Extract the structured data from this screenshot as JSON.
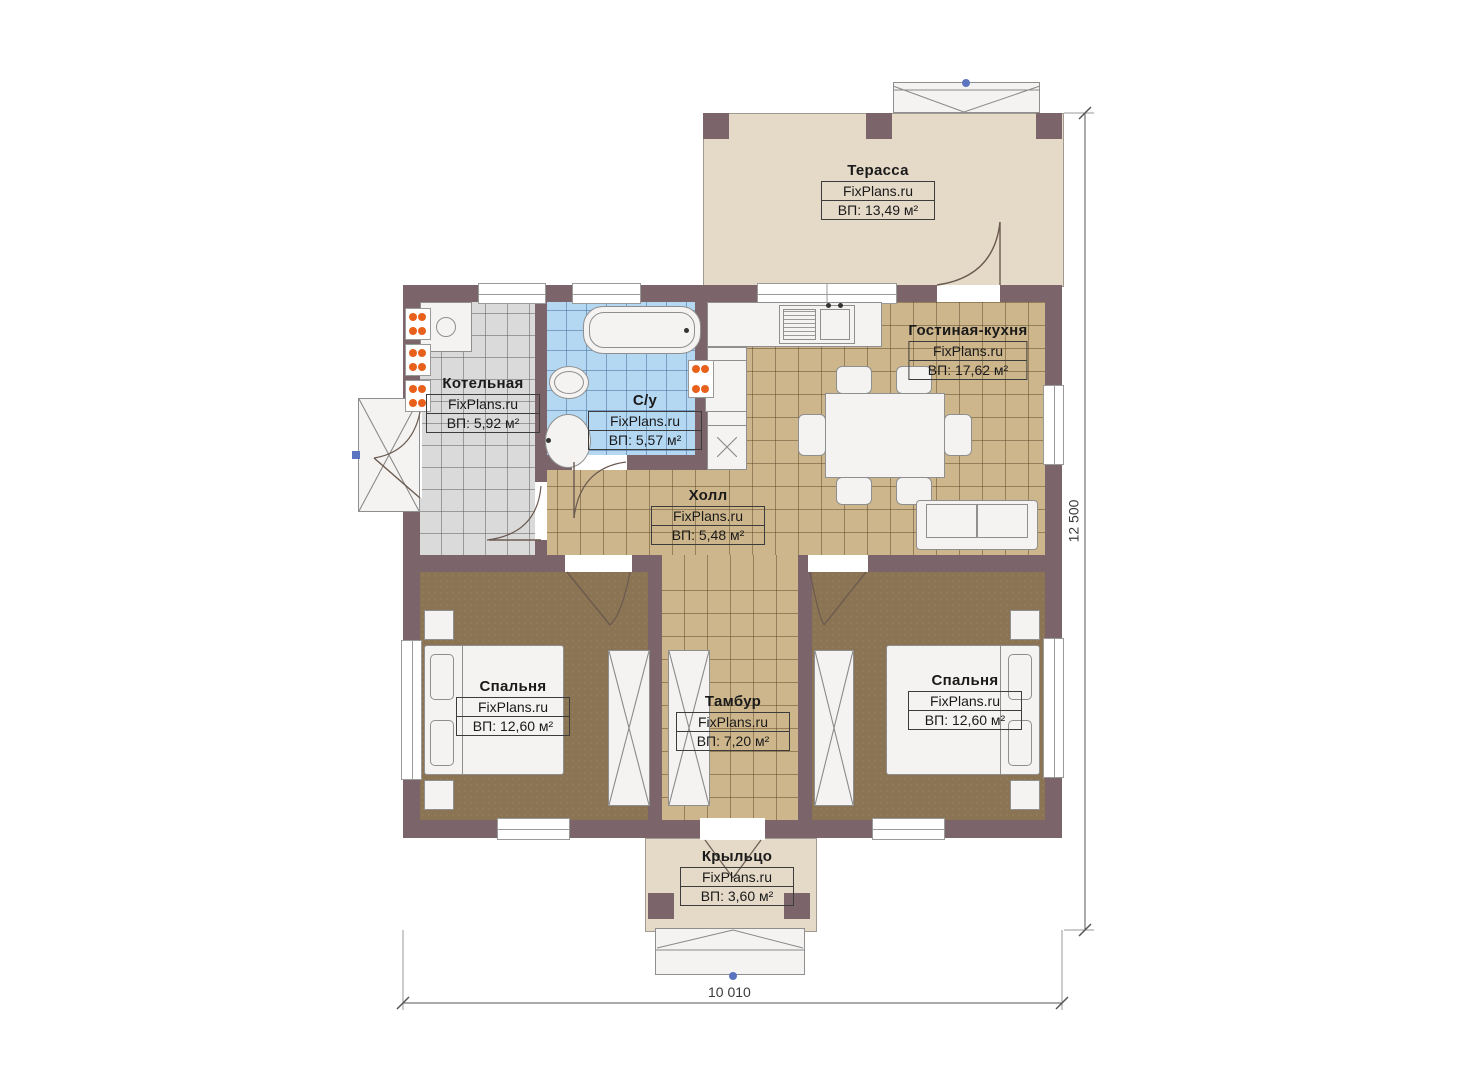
{
  "brand": "FixPlans.ru",
  "plan": {
    "rooms": [
      {
        "name": "Терасса",
        "area": "ВП: 13,49 м²"
      },
      {
        "name": "Гостиная-кухня",
        "area": "ВП: 17,62 м²"
      },
      {
        "name": "Котельная",
        "area": "ВП: 5,92 м²"
      },
      {
        "name": "С/у",
        "area": "ВП: 5,57 м²"
      },
      {
        "name": "Холл",
        "area": "ВП: 5,48 м²"
      },
      {
        "name": "Спальня",
        "area": "ВП: 12,60 м²"
      },
      {
        "name": "Тамбур",
        "area": "ВП: 7,20 м²"
      },
      {
        "name": "Спальня",
        "area": "ВП: 12,60 м²"
      },
      {
        "name": "Крыльцо",
        "area": "ВП: 3,60 м²"
      }
    ],
    "dimensions": {
      "width_label": "10 010",
      "height_label": "12 500"
    },
    "colors": {
      "wall": "#7b656b",
      "terrace_floor": "#e5dac8",
      "tile_floor": "#cdb68c",
      "bath_floor": "#b4d7f2",
      "boiler_floor": "#dadada",
      "bedroom_floor": "#8b7453",
      "radiator": "#e8611c"
    }
  }
}
